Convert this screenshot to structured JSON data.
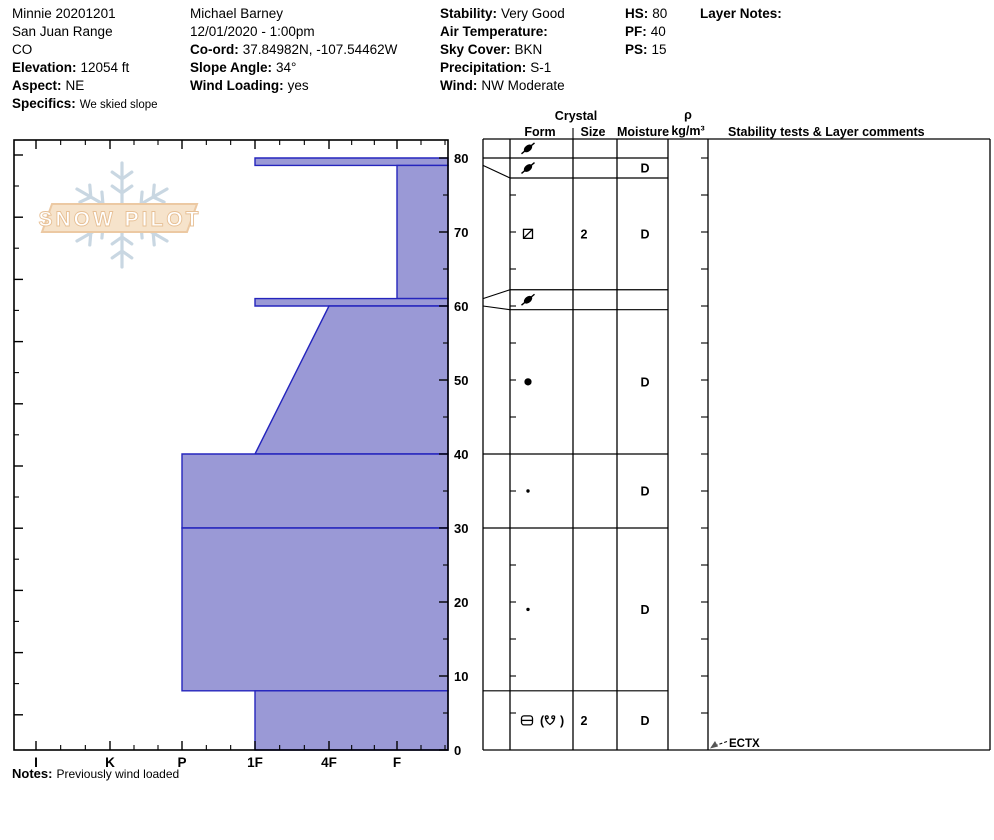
{
  "header": {
    "columns": [
      {
        "name": "location",
        "lines": [
          {
            "v": "Minnie 20201201"
          },
          {
            "v": "San Juan Range"
          },
          {
            "v": "CO"
          },
          {
            "l": "Elevation:",
            "v": "12054 ft"
          },
          {
            "l": "Aspect:",
            "v": "NE"
          },
          {
            "l": "Specifics:",
            "v": "We skied slope",
            "small": true
          }
        ]
      },
      {
        "name": "observer",
        "lines": [
          {
            "v": "Michael Barney"
          },
          {
            "v": "12/01/2020 - 1:00pm"
          },
          {
            "l": "Co-ord:",
            "v": "37.84982N, -107.54462W"
          },
          {
            "l": "Slope Angle:",
            "v": "34°"
          },
          {
            "l": "Wind Loading:",
            "v": "yes"
          }
        ]
      },
      {
        "name": "conditions",
        "lines": [
          {
            "l": "Stability:",
            "v": "Very Good"
          },
          {
            "l": "Air Temperature:",
            "v": ""
          },
          {
            "l": "Sky Cover:",
            "v": "BKN"
          },
          {
            "l": "Precipitation:",
            "v": "S-1"
          },
          {
            "l": "Wind:",
            "v": "NW Moderate"
          }
        ]
      },
      {
        "name": "snow-heights",
        "lines": [
          {
            "l": "HS:",
            "v": "80"
          },
          {
            "l": "PF:",
            "v": "40"
          },
          {
            "l": "PS:",
            "v": "15"
          }
        ]
      },
      {
        "name": "layer-notes",
        "lines": [
          {
            "l": "Layer Notes:",
            "v": ""
          }
        ]
      }
    ]
  },
  "logo": {
    "text": "SNOW PILOT"
  },
  "chart_data": {
    "type": "area",
    "title": "Snow pit hardness profile",
    "xlabel": "Hand hardness",
    "ylabel": "Depth (cm)",
    "hardness_categories": [
      "I",
      "K",
      "P",
      "1F",
      "4F",
      "F"
    ],
    "depth_tick_labels": [
      80,
      70,
      60,
      50,
      40,
      30,
      20,
      10,
      0
    ],
    "ylim": [
      0,
      82
    ],
    "grid": false,
    "fill_color": "#9a99d6",
    "line_color": "#2525bd",
    "layers": [
      {
        "top_cm": 80,
        "bottom_cm": 79,
        "hardness_top": "1F",
        "hardness_bottom": "1F"
      },
      {
        "top_cm": 79,
        "bottom_cm": 61,
        "hardness_top": "F",
        "hardness_bottom": "F"
      },
      {
        "top_cm": 61,
        "bottom_cm": 60,
        "hardness_top": "1F",
        "hardness_bottom": "1F"
      },
      {
        "top_cm": 60,
        "bottom_cm": 40,
        "hardness_top": "4F",
        "hardness_bottom": "1F"
      },
      {
        "top_cm": 40,
        "bottom_cm": 30,
        "hardness_top": "P",
        "hardness_bottom": "P"
      },
      {
        "top_cm": 30,
        "bottom_cm": 8,
        "hardness_top": "P",
        "hardness_bottom": "P"
      },
      {
        "top_cm": 8,
        "bottom_cm": 0,
        "hardness_top": "1F",
        "hardness_bottom": "1F"
      }
    ]
  },
  "table": {
    "headers": {
      "crystal": "Crystal",
      "form": "Form",
      "size": "Size",
      "moisture": "Moisture",
      "rho": "ρ",
      "rho_unit": "kg/m³",
      "stability": "Stability tests & Layer comments"
    },
    "rows": [
      {
        "band": [
          82.6,
          80
        ],
        "form": "DF",
        "size": "",
        "moisture": ""
      },
      {
        "band": [
          80,
          77.3
        ],
        "form": "DF",
        "size": "",
        "moisture": "D"
      },
      {
        "band": [
          77.3,
          62.2
        ],
        "form": "FCxr",
        "size": "2",
        "moisture": "D"
      },
      {
        "band": [
          62.2,
          59.5
        ],
        "form": "DF",
        "size": "",
        "moisture": ""
      },
      {
        "band": [
          59.5,
          40
        ],
        "form": "RG",
        "size": "",
        "moisture": "D"
      },
      {
        "band": [
          40,
          30
        ],
        "form": "RGsm",
        "size": "",
        "moisture": "D"
      },
      {
        "band": [
          30,
          8
        ],
        "form": "RGsm",
        "size": "",
        "moisture": "D"
      },
      {
        "band": [
          8,
          0
        ],
        "form": "MFcr(DH)",
        "size": "2",
        "moisture": "D"
      }
    ],
    "separators": [
      {
        "cm": 80,
        "full": true
      },
      {
        "cm": 77.3,
        "full": false
      },
      {
        "cm": 62.2,
        "full": false
      },
      {
        "cm": 59.5,
        "full": false
      },
      {
        "cm": 40,
        "full": true
      },
      {
        "cm": 30,
        "full": true
      },
      {
        "cm": 8,
        "full": true
      }
    ],
    "leaders": [
      {
        "true_cm": 79,
        "band_cm": 77.3
      },
      {
        "true_cm": 61,
        "band_cm": 62.2
      },
      {
        "true_cm": 60,
        "band_cm": 59.5
      }
    ],
    "stability_tests": [
      {
        "label": "ECTX",
        "at_cm": 0
      }
    ]
  },
  "notes": {
    "label": "Notes:",
    "value": "Previously wind loaded"
  }
}
